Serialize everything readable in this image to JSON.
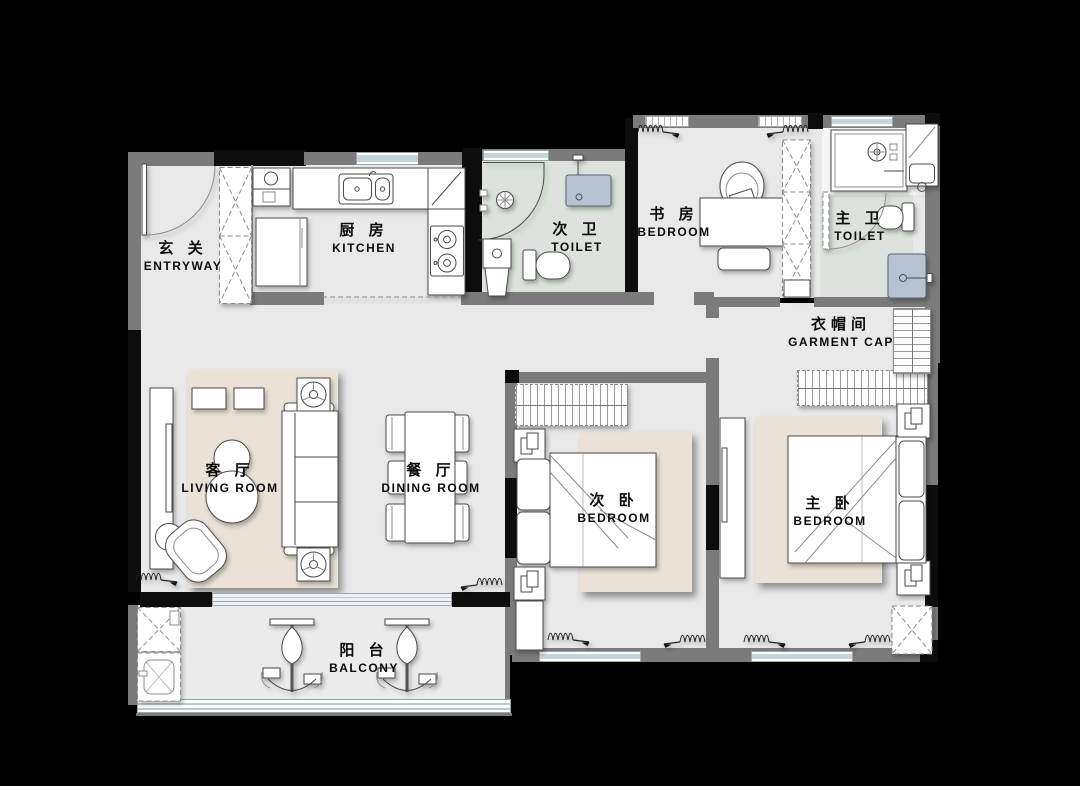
{
  "canvas": {
    "width": 1080,
    "height": 786,
    "background": "#000000"
  },
  "rooms": {
    "entryway": {
      "zh": "玄 关",
      "en": "ENTRYWAY"
    },
    "kitchen": {
      "zh": "厨 房",
      "en": "KITCHEN"
    },
    "secondary_toilet": {
      "zh": "次 卫",
      "en": "TOILET"
    },
    "study": {
      "zh": "书 房",
      "en": "BEDROOM"
    },
    "master_toilet": {
      "zh": "主 卫",
      "en": "TOILET"
    },
    "garment_cap": {
      "zh": "衣帽间",
      "en": "GARMENT CAP"
    },
    "living": {
      "zh": "客 厅",
      "en": "LIVING ROOM"
    },
    "dining": {
      "zh": "餐 厅",
      "en": "DINING ROOM"
    },
    "secondary_bedroom": {
      "zh": "次 卧",
      "en": "BEDROOM"
    },
    "master_bedroom": {
      "zh": "主 卧",
      "en": "BEDROOM"
    },
    "balcony": {
      "zh": "阳 台",
      "en": "BALCONY"
    }
  },
  "colors": {
    "floor": "#e9e9e9",
    "wet_floor": "#dde3dc",
    "balcony_floor": "#ececec",
    "rug": "#eae2d6",
    "wall": "#7b7b7b",
    "column": "#0d0d0d",
    "window_glass": "#b9cbd4",
    "fixture_blue": "#b7c3d1",
    "line": "#4a4a4a",
    "background": "#000000"
  }
}
